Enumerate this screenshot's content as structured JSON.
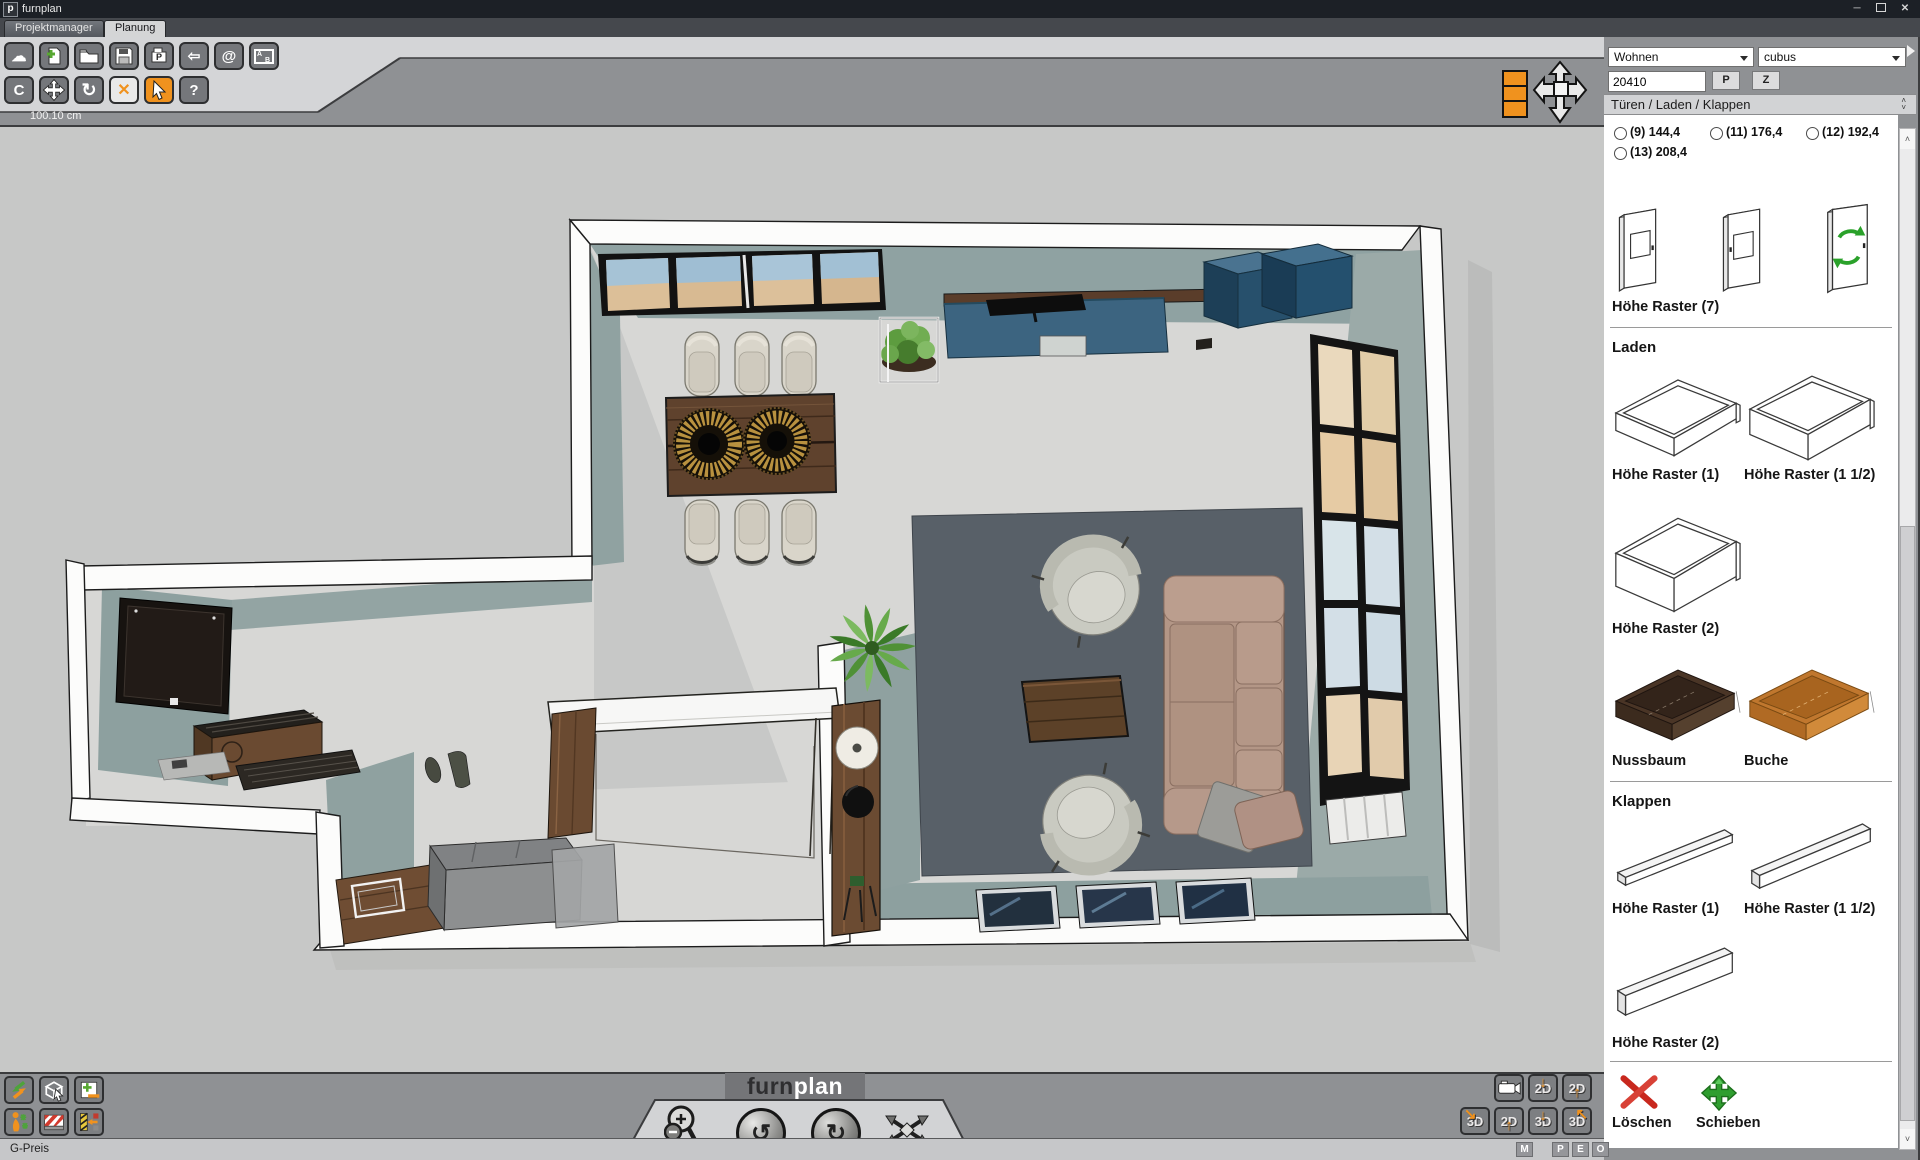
{
  "window": {
    "title": "furnplan"
  },
  "tabs": [
    {
      "label": "Projektmanager",
      "active": false
    },
    {
      "label": "Planung",
      "active": true
    }
  ],
  "toolbar": {
    "measure_label": "100.10 cm",
    "row1_icons": [
      "cloud",
      "new-document",
      "open-folder",
      "save",
      "print",
      "back-arrow",
      "email-at",
      "label-ab"
    ],
    "row2_icons": [
      "c-tool",
      "move",
      "rotate",
      "delete-x",
      "select-cursor",
      "help"
    ],
    "active_tool": "select-cursor",
    "at_label": "@",
    "c_label": "C",
    "help_label": "?"
  },
  "canvas_controls": {
    "icons": [
      "layer-stack",
      "pan-cross"
    ]
  },
  "sidebar": {
    "category_select": "Wohnen",
    "model_select": "cubus",
    "article_input": "20410",
    "p_button": "P",
    "z_button": "Z",
    "section_header": "Türen / Laden / Klappen",
    "radios": [
      {
        "label": "(9) 144,4",
        "checked": false
      },
      {
        "label": "(11) 176,4",
        "checked": false
      },
      {
        "label": "(12) 192,4",
        "checked": false
      },
      {
        "label": "(13) 208,4",
        "checked": false
      }
    ],
    "doors_label": "Höhe Raster (7)",
    "laden_heading": "Laden",
    "laden_items": [
      "Höhe Raster (1)",
      "Höhe Raster (1 1/2)",
      "Höhe Raster (2)",
      "Nussbaum",
      "Buche"
    ],
    "klappen_heading": "Klappen",
    "klappen_items": [
      "Höhe Raster (1)",
      "Höhe Raster (1 1/2)",
      "Höhe Raster (2)"
    ],
    "delete_label": "Löschen",
    "move_label": "Schieben"
  },
  "bottom_bar": {
    "logo_furn": "furn",
    "logo_plan": "plan",
    "view_2d": "2D",
    "view_3d": "3D",
    "left_icons_row1": [
      "import-export-arrows",
      "box-select",
      "add-remove-plan"
    ],
    "left_icons_row2": [
      "walkthrough-person",
      "barrier",
      "measure-move"
    ],
    "center_icons": [
      "zoom-magnifier",
      "rotate-view-left",
      "rotate-view-right",
      "spin-view"
    ],
    "right_icons_row1": [
      "camera",
      "2d-down",
      "2d-up"
    ],
    "right_icons_row2": [
      "3d-corner",
      "2d-up",
      "3d-down",
      "3d-bend"
    ]
  },
  "status_bar": {
    "left": "G-Preis",
    "boxes": [
      "M",
      "P",
      "E",
      "O"
    ]
  },
  "colors": {
    "accent_orange": "#f0921e",
    "wall_face_sage": "#8fa1a0",
    "floor": "#d7d7d5",
    "canvas_bg": "#c7c8c7",
    "rug": "#586068",
    "sofa_leather": "#b39686",
    "sideboard_teal": "#3c6480",
    "wood_walnut": "#6a4a31",
    "nussbaum": "#4a3526",
    "buche": "#c0772e",
    "delete_red": "#c8281e",
    "move_green": "#2f9e2f"
  }
}
